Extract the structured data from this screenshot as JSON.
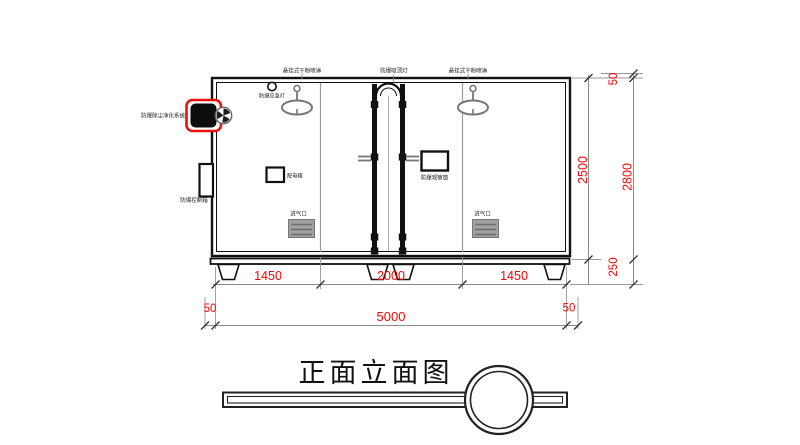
{
  "labels": {
    "sprinkler_left": "悬挂式干粉喷淋",
    "ceiling_lamp": "防爆吸顶灯",
    "sprinkler_right": "悬挂式干粉喷淋",
    "purifier": "防爆除尘净化系统",
    "emergency_light": "防爆应急灯",
    "control_box": "防爆控制箱",
    "power_panel": "配电箱",
    "observation_window": "防爆观察窗",
    "air_inlet_left": "进气口",
    "air_inlet_right": "进气口"
  },
  "dimensions": {
    "bay_left": "1450",
    "bay_middle": "2000",
    "bay_right": "1450",
    "margin_left": "50",
    "overall_width": "5000",
    "margin_right": "50",
    "body_height": "2500",
    "roof_offset": "50",
    "overall_height": "2800",
    "base_height": "250"
  },
  "title": "正面立面图",
  "colors": {
    "dimension_text": "#fe0000",
    "highlight_outline": "#e8140c",
    "line": "#111111",
    "gray_line": "#8a8a8a"
  }
}
